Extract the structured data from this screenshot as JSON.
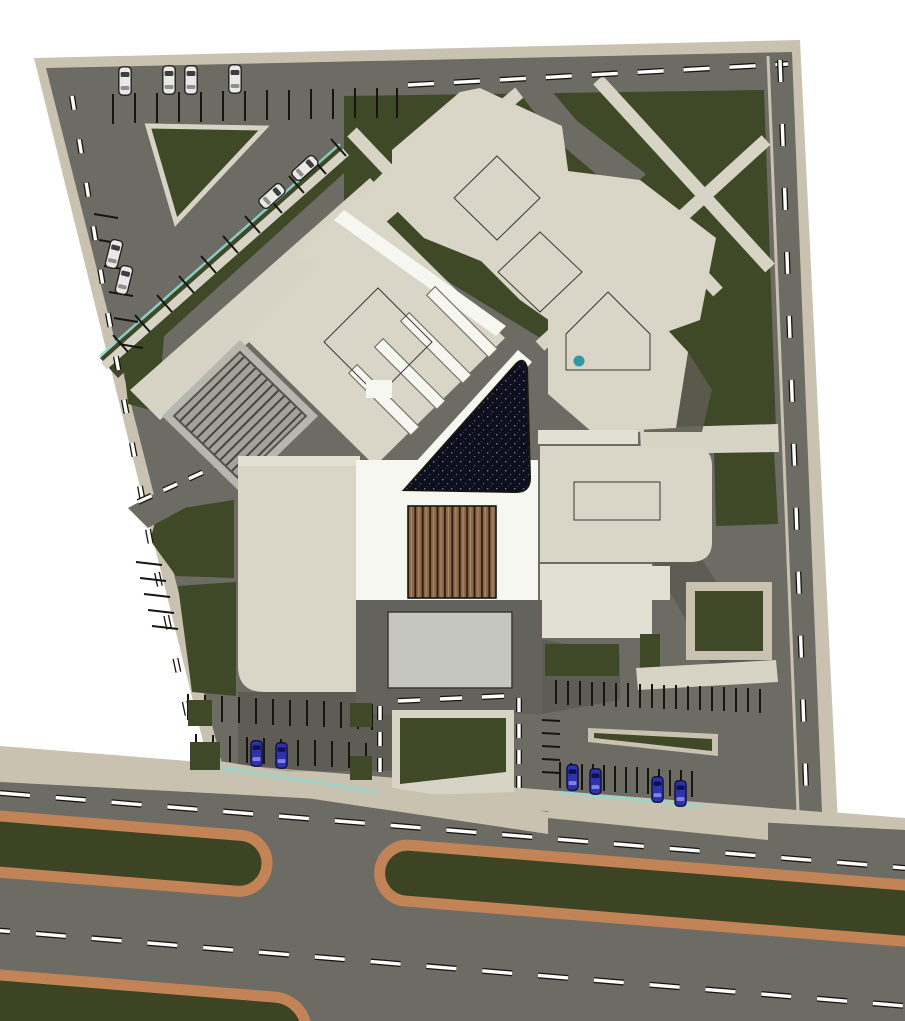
{
  "meta": {
    "title": "Rendered architectural site plan, top view, of a building complex with landscaped grounds, perimeter roads, parking lots and a boulevard with planted median islands",
    "width": 905,
    "height": 1021
  },
  "palette": {
    "bg": "#ffffff",
    "road": "#6c6b64",
    "road_dark": "#63625c",
    "sidewalk": "#c9c2b1",
    "path": "#d8d4c5",
    "plaza_light": "#b7b6af",
    "green": "#3f4827",
    "roof": "#d9d6c7",
    "roof_light": "#e2dfd3",
    "roof_white": "#f7f7f2",
    "canopy": "#c6c6c0",
    "trellis": "#a2a29b",
    "side_face": "#5c5c50",
    "ink": "#16160f",
    "outline": "#3a3a33",
    "lane": "#ffffff",
    "teal": "#8fd8d0",
    "teal_dot": "#2e9aa6",
    "louver_brown": "#8a6547",
    "louver_dark": "#241a10",
    "louver_light": "#b08a63",
    "skylight_base": "#131318",
    "skylight_hatch": "#8e939b",
    "glass_navy": "#0d0e1e",
    "glass_speck": "#7a7d96",
    "blue_roof": "#4a4fa0",
    "blue_roof_line": "#23255e",
    "median_edge": "#c28457",
    "median_green": "#3c4424",
    "car_white": "#e8e8e6",
    "car_blue": "#2e33ad",
    "car_glass": "#3e3e3e"
  },
  "scene": {
    "site": "trapezoidal site bounded by roads on top, left and right, boulevard at bottom",
    "boulevard": {
      "lane_lines": 2,
      "median_islands": 3,
      "median_style": "green strip with orange curb"
    },
    "parking": {
      "white_cars_top_row": 4,
      "white_cars_diagonal_row": 2,
      "white_cars_left_road": 2,
      "blue_cars_bottom_left_lot": 2,
      "blue_cars_bottom_right_lot": 4
    },
    "buildings": {
      "roof_color": "beige",
      "diamond_skylights_dark": 2,
      "pentagon_skylight_with_teal_dot": 1,
      "blue_diamond_skylight": 1,
      "dark_glass_atrium": "triangular, navy speckled glazing with white border",
      "wood_louver_roof": "vertical brown slats at main entrance",
      "gray_trellis": "striped diamond pergola at west drop-off"
    },
    "landscape": "dark olive lawns crossed by diagonal beige walkways; triangular lawn island in north-west parking"
  }
}
